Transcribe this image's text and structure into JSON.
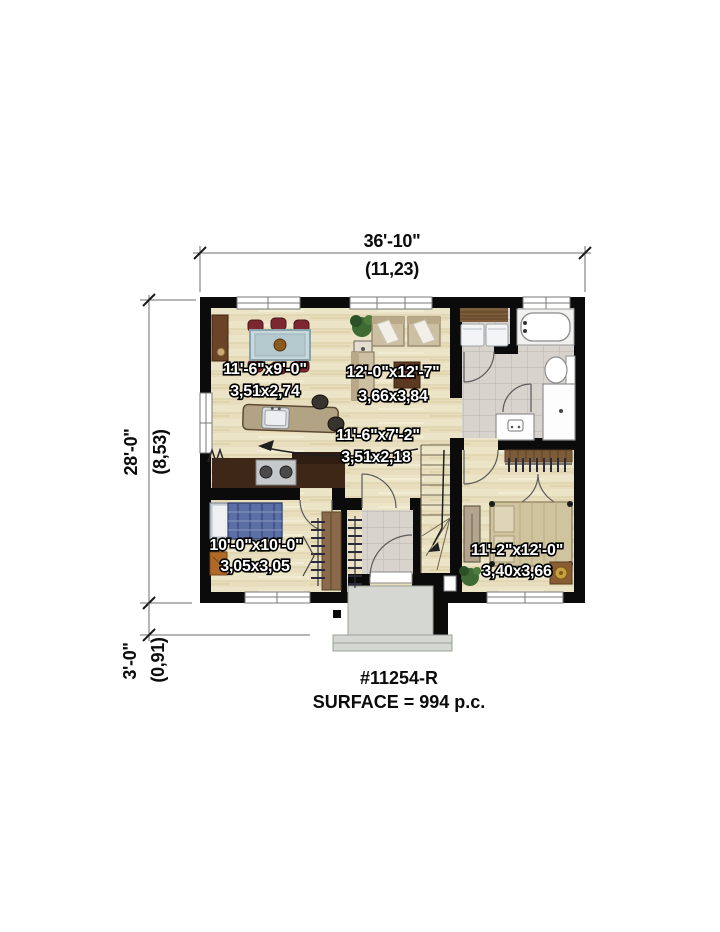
{
  "plan": {
    "plan_number": "#11254-R",
    "surface": "SURFACE = 994 p.c.",
    "dimensions": {
      "width": {
        "imperial": "36'-10\"",
        "metric": "(11,23)"
      },
      "height": {
        "imperial": "28'-0\"",
        "metric": "(8,53)"
      },
      "porch_depth": {
        "imperial": "3'-0\"",
        "metric": "(0,91)"
      }
    },
    "rooms": [
      {
        "name": "dining-kitchen",
        "imperial": "11'-6\"x9'-0\"",
        "metric": "3,51x2,74"
      },
      {
        "name": "living-room",
        "imperial": "12'-0\"x12'-7\"",
        "metric": "3,66x3,84"
      },
      {
        "name": "hall",
        "imperial": "11'-6\"x7'-2\"",
        "metric": "3,51x2,18"
      },
      {
        "name": "bedroom-front",
        "imperial": "10'-0\"x10'-0\"",
        "metric": "3,05x3,05"
      },
      {
        "name": "bedroom-rear",
        "imperial": "11'-2\"x12'-0\"",
        "metric": "3,40x3,66"
      }
    ],
    "colors": {
      "wall": "#0b0b0b",
      "wood_floor": "#ece4c6",
      "tile_floor": "#d8d3cc",
      "porch": "#d5d8d2",
      "counter": "#3f2718",
      "island": "#b2a384",
      "chair_red": "#7d2730",
      "closet_wood": "#8a6a4a",
      "bed_blue": "#5a6fa5",
      "bed_tan": "#cfc49e",
      "label_fill": "#ffffff",
      "label_stroke": "#000000"
    }
  }
}
